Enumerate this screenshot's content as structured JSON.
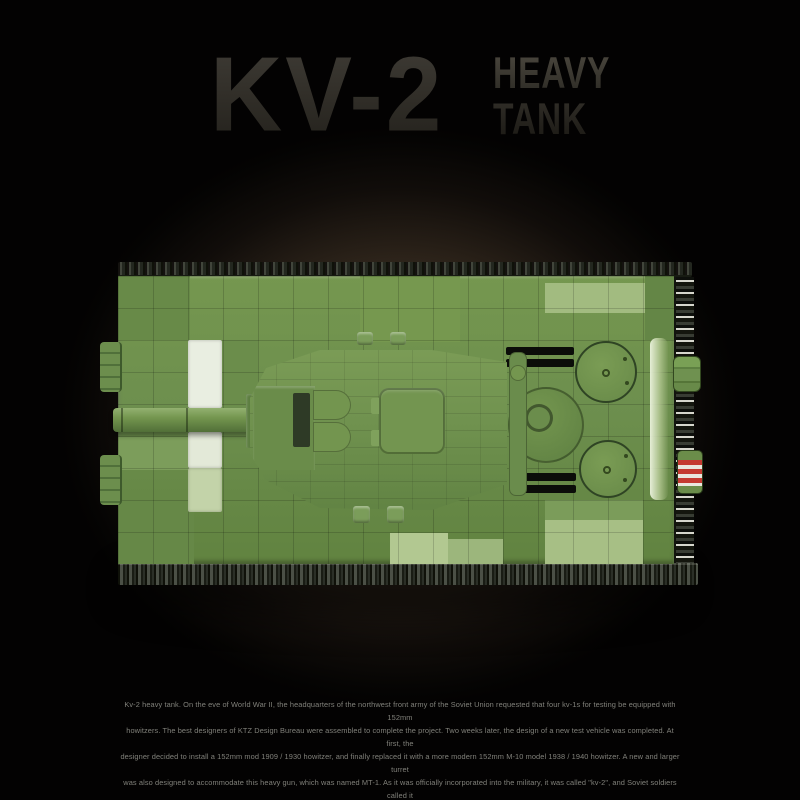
{
  "title": {
    "main": "KV-2",
    "sub1": "HEAVY",
    "sub2": "TANK"
  },
  "description": {
    "lines": [
      "Kv-2 heavy tank. On the eve of World War II, the headquarters of the northwest front army of the Soviet Union requested that four kv-1s for testing be equipped with 152mm",
      "howitzers. The best designers of KTZ Design Bureau were assembled to complete the project. Two weeks later, the design of a new test vehicle was completed. At first, the",
      "designer decided to install a 152mm mod 1909 / 1930 howitzer, and finally replaced it with a more modern 152mm M-10 model 1938 / 1940 howitzer. A new and larger turret",
      "was also designed to accommodate this heavy gun, which was named MT-1. As it was officially incorporated into the military, it was called \"kv-2\", and Soviet soldiers called it",
      "\"KV's Bolshoi bashnei\". Equipped with 152mm howitzers, it has powerful firepower, and its huge body is called \"giant\" by the German army."
    ]
  },
  "colors": {
    "tank_green": "#6d8f4e",
    "tank_green_pale": "#c6d6ac",
    "accent_white": "#e9eee1",
    "exhaust_red": "#c43a31",
    "background_glow": "#55463a",
    "title_gray": "#3a3732",
    "text_gray": "#8c8c85"
  }
}
